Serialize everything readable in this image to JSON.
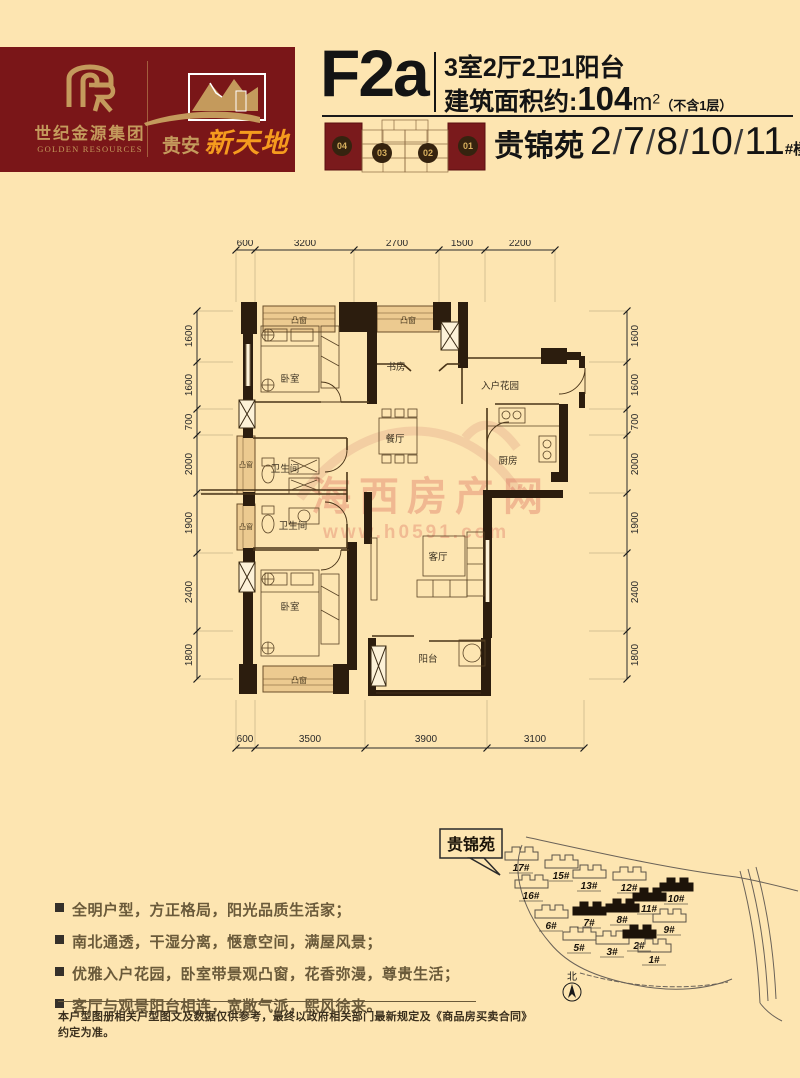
{
  "brand": {
    "monogram": "GR",
    "company_cn": "世纪金源集团",
    "company_en": "GOLDEN RESOURCES",
    "project_prefix": "贵安",
    "project_name": "新天地"
  },
  "unit": {
    "code": "F2a",
    "layout": "3室2厅2卫1阳台",
    "area_label": "建筑面积约:",
    "area_value": "104",
    "area_unit": "m",
    "area_sup": "2",
    "area_note": "（不含1层）"
  },
  "location": {
    "zone": "贵锦苑",
    "buildings": [
      "2",
      "7",
      "8",
      "10",
      "11"
    ],
    "separator": "/",
    "suffix": "#楼"
  },
  "keyplan": {
    "units": [
      "04",
      "03",
      "02",
      "01"
    ]
  },
  "floorplan": {
    "rooms": [
      "卧室",
      "书房",
      "入户花园",
      "餐厅",
      "厨房",
      "卫生间",
      "卫生间",
      "客厅",
      "卧室",
      "阳台"
    ],
    "bay_window_label": "凸窗",
    "bay_window_count": 5,
    "dims_top": [
      "600",
      "3200",
      "2700",
      "1500",
      "2200"
    ],
    "dims_bottom": [
      "600",
      "3500",
      "3900",
      "3100"
    ],
    "dims_left": [
      "1600",
      "1600",
      "700",
      "2000",
      "1900",
      "2400",
      "1800"
    ],
    "dims_right": [
      "1600",
      "1600",
      "700",
      "2000",
      "1900",
      "2400",
      "1800"
    ],
    "watermark_line1": "海西房产网",
    "watermark_line2": "www.h0591.com"
  },
  "features": [
    "全明户型，方正格局，阳光品质生活家；",
    "南北通透，干湿分离，惬意空间，满屋风景；",
    "优雅入户花园，卧室带景观凸窗，花香弥漫，尊贵生活；",
    "客厅与观景阳台相连，宽敞气派，熙风徐来。"
  ],
  "disclaimer": "本户型图册相关户型图文及数据仅供参考，最终以政府相关部门最新规定及《商品房买卖合同》约定为准。",
  "sitemap": {
    "callout": "贵锦苑",
    "north": "北",
    "buildings": [
      {
        "label": "17#",
        "highlight": false
      },
      {
        "label": "15#",
        "highlight": false
      },
      {
        "label": "13#",
        "highlight": false
      },
      {
        "label": "12#",
        "highlight": false
      },
      {
        "label": "16#",
        "highlight": false
      },
      {
        "label": "11#",
        "highlight": true
      },
      {
        "label": "10#",
        "highlight": true
      },
      {
        "label": "6#",
        "highlight": false
      },
      {
        "label": "7#",
        "highlight": true
      },
      {
        "label": "8#",
        "highlight": true
      },
      {
        "label": "9#",
        "highlight": false
      },
      {
        "label": "5#",
        "highlight": false
      },
      {
        "label": "3#",
        "highlight": false
      },
      {
        "label": "2#",
        "highlight": true
      },
      {
        "label": "1#",
        "highlight": false
      }
    ]
  },
  "colors": {
    "background": "#fde5b1",
    "banner": "#7a1618",
    "gold": "#c49a5c",
    "orange": "#f59b1e",
    "wall": "#2c1d0e",
    "bay_fill": "#ecca90",
    "watermark_red": "rgba(213,80,72,0.3)"
  }
}
